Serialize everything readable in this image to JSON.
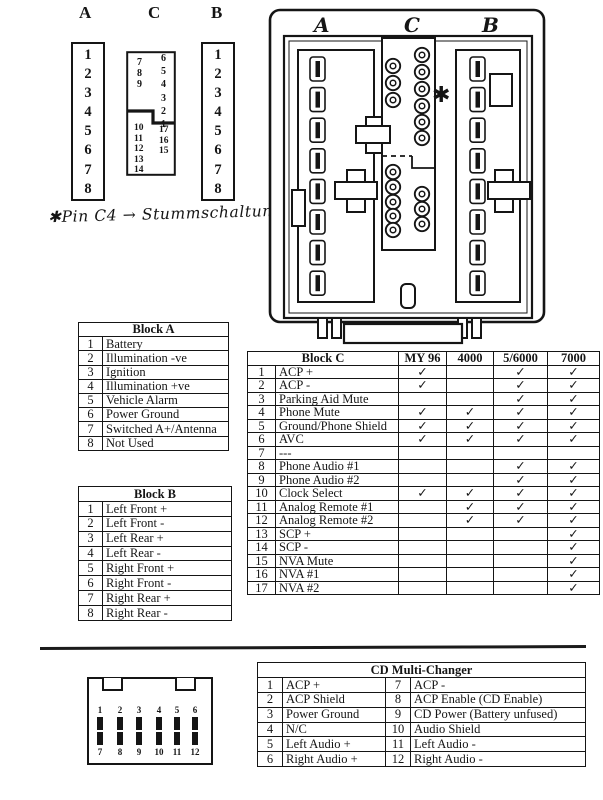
{
  "page": {
    "ink": "#151515",
    "background": "#ffffff"
  },
  "top_connectors": {
    "a": {
      "label": "A",
      "pins": [
        "1",
        "2",
        "3",
        "4",
        "5",
        "6",
        "7",
        "8"
      ]
    },
    "c": {
      "label": "C",
      "top_left_pins": [
        "7",
        "8",
        "9"
      ],
      "top_right_pins": [
        "6",
        "5",
        "4",
        "3",
        "2",
        "1"
      ],
      "bottom_left_pins": [
        "10",
        "11",
        "12",
        "13",
        "14"
      ],
      "bottom_right_pins": [
        "17",
        "16",
        "15"
      ]
    },
    "b": {
      "label": "B",
      "pins": [
        "1",
        "2",
        "3",
        "4",
        "5",
        "6",
        "7",
        "8"
      ]
    }
  },
  "handwritten_note": "✱Pin C4 → Stummschaltung",
  "diagram": {
    "connector_labels": [
      "A",
      "C",
      "B"
    ],
    "asterisk_marker": "✱"
  },
  "tables": {
    "block_a": {
      "title": "Block A",
      "rows": [
        [
          "1",
          "Battery"
        ],
        [
          "2",
          "Illumination -ve"
        ],
        [
          "3",
          "Ignition"
        ],
        [
          "4",
          "Illumination +ve"
        ],
        [
          "5",
          "Vehicle Alarm"
        ],
        [
          "6",
          "Power Ground"
        ],
        [
          "7",
          "Switched A+/Antenna"
        ],
        [
          "8",
          "Not Used"
        ]
      ]
    },
    "block_b": {
      "title": "Block B",
      "rows": [
        [
          "1",
          "Left Front +"
        ],
        [
          "2",
          "Left Front -"
        ],
        [
          "3",
          "Left Rear +"
        ],
        [
          "4",
          "Left Rear -"
        ],
        [
          "5",
          "Right Front +"
        ],
        [
          "6",
          "Right Front -"
        ],
        [
          "7",
          "Right Rear +"
        ],
        [
          "8",
          "Right Rear -"
        ]
      ]
    },
    "block_c": {
      "title": "Block C",
      "model_columns": [
        "MY 96",
        "4000",
        "5/6000",
        "7000"
      ],
      "check_glyph": "✓",
      "rows": [
        {
          "pin": "1",
          "name": "ACP +",
          "checks": [
            1,
            0,
            1,
            1
          ]
        },
        {
          "pin": "2",
          "name": "ACP -",
          "checks": [
            1,
            0,
            1,
            1
          ]
        },
        {
          "pin": "3",
          "name": "Parking Aid Mute",
          "checks": [
            0,
            0,
            1,
            1
          ]
        },
        {
          "pin": "4",
          "name": "Phone Mute",
          "checks": [
            1,
            1,
            1,
            1
          ]
        },
        {
          "pin": "5",
          "name": "Ground/Phone Shield",
          "checks": [
            1,
            1,
            1,
            1
          ]
        },
        {
          "pin": "6",
          "name": "AVC",
          "checks": [
            1,
            1,
            1,
            1
          ]
        },
        {
          "pin": "7",
          "name": "---",
          "checks": [
            0,
            0,
            0,
            0
          ]
        },
        {
          "pin": "8",
          "name": "Phone Audio #1",
          "checks": [
            0,
            0,
            1,
            1
          ]
        },
        {
          "pin": "9",
          "name": "Phone Audio #2",
          "checks": [
            0,
            0,
            1,
            1
          ]
        },
        {
          "pin": "10",
          "name": "Clock Select",
          "checks": [
            1,
            1,
            1,
            1
          ]
        },
        {
          "pin": "11",
          "name": "Analog Remote #1",
          "checks": [
            0,
            1,
            1,
            1
          ]
        },
        {
          "pin": "12",
          "name": "Analog Remote #2",
          "checks": [
            0,
            1,
            1,
            1
          ]
        },
        {
          "pin": "13",
          "name": "SCP +",
          "checks": [
            0,
            0,
            0,
            1
          ]
        },
        {
          "pin": "14",
          "name": "SCP -",
          "checks": [
            0,
            0,
            0,
            1
          ]
        },
        {
          "pin": "15",
          "name": "NVA Mute",
          "checks": [
            0,
            0,
            0,
            1
          ]
        },
        {
          "pin": "16",
          "name": "NVA #1",
          "checks": [
            0,
            0,
            0,
            1
          ]
        },
        {
          "pin": "17",
          "name": "NVA #2",
          "checks": [
            0,
            0,
            0,
            1
          ]
        }
      ]
    },
    "cd_changer": {
      "title": "CD Multi-Changer",
      "rows": [
        [
          "1",
          "ACP +",
          "7",
          "ACP -"
        ],
        [
          "2",
          "ACP Shield",
          "8",
          "ACP Enable (CD Enable)"
        ],
        [
          "3",
          "Power Ground",
          "9",
          "CD Power (Battery unfused)"
        ],
        [
          "4",
          "N/C",
          "10",
          "Audio Shield"
        ],
        [
          "5",
          "Left Audio +",
          "11",
          "Left Audio -"
        ],
        [
          "6",
          "Right Audio +",
          "12",
          "Right Audio -"
        ]
      ]
    }
  },
  "bottom_connector": {
    "top_pins": [
      "1",
      "2",
      "3",
      "4",
      "5",
      "6"
    ],
    "bottom_pins": [
      "7",
      "8",
      "9",
      "10",
      "11",
      "12"
    ]
  }
}
